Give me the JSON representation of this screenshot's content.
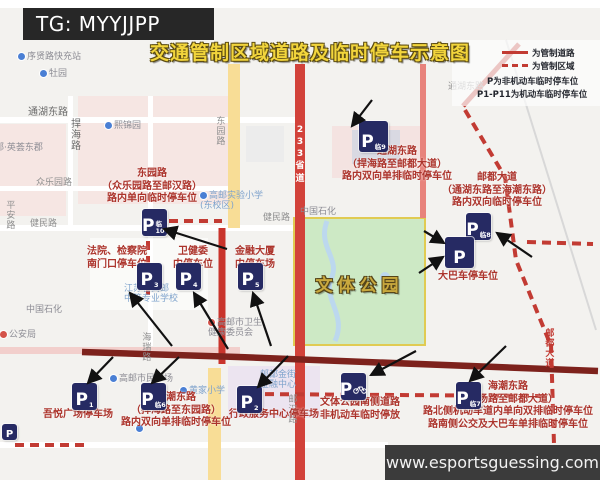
{
  "header": {
    "tg_label": "TG: MYYJJPP"
  },
  "title": "交通管制区域道路及临时停车示意图",
  "watermark": {
    "url_text": "www.esportsguessing.com"
  },
  "legend": {
    "rows": [
      {
        "swatch": "solid-red-line",
        "text": "为管制道路"
      },
      {
        "swatch": "dashed-red-line",
        "text": "为管制区域"
      },
      {
        "swatch": "none",
        "text": "P为非机动车临时停车位"
      },
      {
        "swatch": "none",
        "text": "P1-P11为机动车临时停车位"
      }
    ]
  },
  "park": {
    "name": "文体公园"
  },
  "colors": {
    "control_road_red": "#c23b33",
    "control_zone_dash_red": "#c23b33",
    "annotation_red": "#ac342c",
    "parking_icon_navy": "#262a63",
    "park_green": "#cde9c5",
    "park_border_yellow": "#e0cb52",
    "title_gold": "#f2d53c",
    "route_233_red": "#d2423a",
    "haichao_road_maroon": "#7d221c"
  },
  "map": {
    "labels": [
      {
        "name": "poi-xuxian-road-charging-station",
        "text": "序贤路快充站",
        "x": 18,
        "y": 52,
        "style": "poi",
        "pin": "blue"
      },
      {
        "name": "poi-muyuan",
        "text": "牡园",
        "x": 40,
        "y": 69,
        "style": "poi",
        "pin": "blue"
      },
      {
        "name": "road-label-tonghu-east-west",
        "text": "通湖东路",
        "x": 28,
        "y": 107,
        "style": "road-dark"
      },
      {
        "name": "road-label-tonghu-east-east",
        "text": "通湖东路",
        "x": 448,
        "y": 82,
        "style": "road"
      },
      {
        "name": "road-label-hanhai",
        "text": "捍海路",
        "x": 68,
        "y": 118,
        "style": "road-dark",
        "vertical": true
      },
      {
        "name": "road-label-dongyuan",
        "text": "东园路",
        "x": 214,
        "y": 116,
        "style": "road",
        "vertical": true
      },
      {
        "name": "poi-xijinyuan",
        "text": "熙锦园",
        "x": 105,
        "y": 121,
        "style": "poi",
        "pin": "blue"
      },
      {
        "name": "poi-yinghui-dongjun",
        "text": "南邮·英荟东郡",
        "x": -14,
        "y": 143,
        "style": "poi"
      },
      {
        "name": "road-label-zhongleyuan",
        "text": "众乐园路",
        "x": 36,
        "y": 178,
        "style": "road"
      },
      {
        "name": "road-label-pingan",
        "text": "平安路",
        "x": 4,
        "y": 200,
        "style": "road",
        "vertical": true
      },
      {
        "name": "road-label-jianmin-west",
        "text": "健民路",
        "x": 30,
        "y": 219,
        "style": "road"
      },
      {
        "name": "road-label-jianmin-east",
        "text": "健民路",
        "x": 263,
        "y": 213,
        "style": "road"
      },
      {
        "name": "poi-sinopec-east",
        "text": "中国石化",
        "x": 300,
        "y": 207,
        "style": "poi"
      },
      {
        "name": "poi-gaoyou-experimental-school",
        "lines": [
          "高邮实验小学",
          "(东校区)"
        ],
        "x": 200,
        "y": 191,
        "style": "poi-blue",
        "pin": "blue"
      },
      {
        "name": "poi-jiangsu-gaoyou-vocational-school",
        "lines": [
          "江苏省高邮",
          "中等专业学校"
        ],
        "x": 124,
        "y": 284,
        "style": "poi-blue"
      },
      {
        "name": "poi-sinopec-west",
        "text": "中国石化",
        "x": 26,
        "y": 305,
        "style": "poi"
      },
      {
        "name": "poi-health-commission",
        "lines": [
          "高邮市卫生",
          "健康委员会"
        ],
        "x": 208,
        "y": 318,
        "style": "poi",
        "pin": "red"
      },
      {
        "name": "poi-public-security-bureau",
        "text": "公安局",
        "x": 0,
        "y": 330,
        "style": "poi",
        "pin": "red"
      },
      {
        "name": "poi-gaoyou-civic-plaza",
        "text": "高邮市民广场",
        "x": 110,
        "y": 374,
        "style": "poi",
        "pin": "blue"
      },
      {
        "name": "poi-huangjia-school",
        "text": "黄家小学",
        "x": 180,
        "y": 386,
        "style": "poi-blue",
        "pin": "blue"
      },
      {
        "name": "poi-youdu-jinjie-finance-center",
        "lines": [
          "邮都金街",
          "金融中心"
        ],
        "x": 260,
        "y": 370,
        "style": "poi-blue"
      },
      {
        "name": "road-label-youhan",
        "text": "邮汉路",
        "x": 286,
        "y": 394,
        "style": "road",
        "vertical": true
      },
      {
        "name": "road-label-hairui",
        "text": "海瑞路",
        "x": 140,
        "y": 332,
        "style": "road",
        "vertical": true
      },
      {
        "name": "road-label-youdu-avenue",
        "text": "邮都大道",
        "x": 543,
        "y": 328,
        "style": "route-red",
        "vertical": true
      },
      {
        "name": "route-shield-233",
        "lines": [
          "2",
          "3",
          "3",
          "省",
          "道"
        ],
        "x": 294,
        "y": 124,
        "style": "route-white"
      },
      {
        "name": "poi-pin-bottom",
        "text": "",
        "x": 136,
        "y": 424,
        "style": "poi",
        "pin": "blue"
      }
    ],
    "p_icons": [
      {
        "id": "p-icon-lin9",
        "p": "P",
        "sub": "临9",
        "x": 359,
        "y": 121,
        "size": "lg"
      },
      {
        "id": "p-icon-lin8",
        "p": "P",
        "sub": "临8",
        "x": 466,
        "y": 213,
        "size": "md"
      },
      {
        "id": "p-icon-bus",
        "p": "P",
        "sub": "",
        "x": 445,
        "y": 237,
        "size": "lg"
      },
      {
        "id": "p-icon-lin10",
        "p": "P",
        "sub": "临10",
        "x": 142,
        "y": 209,
        "size": "md"
      },
      {
        "id": "p-icon-3",
        "p": "P",
        "sub": "3",
        "x": 137,
        "y": 263,
        "size": "md"
      },
      {
        "id": "p-icon-4",
        "p": "P",
        "sub": "4",
        "x": 176,
        "y": 263,
        "size": "md"
      },
      {
        "id": "p-icon-5",
        "p": "P",
        "sub": "5",
        "x": 238,
        "y": 263,
        "size": "md"
      },
      {
        "id": "p-icon-1",
        "p": "P",
        "sub": "1",
        "x": 72,
        "y": 383,
        "size": "md"
      },
      {
        "id": "p-icon-lin6",
        "p": "P",
        "sub": "临6",
        "x": 141,
        "y": 383,
        "size": "md"
      },
      {
        "id": "p-icon-2",
        "p": "P",
        "sub": "2",
        "x": 237,
        "y": 386,
        "size": "md"
      },
      {
        "id": "p-icon-bike",
        "p": "P",
        "sub": "bike",
        "x": 341,
        "y": 373,
        "size": "md"
      },
      {
        "id": "p-icon-lin7",
        "p": "P",
        "sub": "临7",
        "x": 456,
        "y": 382,
        "size": "md"
      },
      {
        "id": "p-icon-small-base",
        "p": "P",
        "sub": "",
        "x": 2,
        "y": 424,
        "size": "sm"
      }
    ],
    "annotations": [
      {
        "id": "annotation-dongyuan-road",
        "lines": [
          "东园路",
          "（众乐园路至邮汉路）",
          "路内单向临时停车位"
        ],
        "cx": 152,
        "y": 168
      },
      {
        "id": "annotation-tonghu-east-road",
        "lines": [
          "通湖东路",
          "（捍海路至邮都大道）",
          "路内双向单排临时停车位"
        ],
        "cx": 397,
        "y": 146
      },
      {
        "id": "annotation-youdu-avenue",
        "lines": [
          "邮都大道",
          "（通湖东路至海潮东路）",
          "路内双向临时停车位"
        ],
        "cx": 497,
        "y": 172
      },
      {
        "id": "annotation-bus-parking",
        "lines": [
          "大巴车停车位"
        ],
        "cx": 468,
        "y": 271
      },
      {
        "id": "annotation-court-procuratorate",
        "lines": [
          "法院、检察院",
          "南门口停车位"
        ],
        "cx": 117,
        "y": 246
      },
      {
        "id": "annotation-health-committee",
        "lines": [
          "卫健委",
          "内停车位"
        ],
        "cx": 193,
        "y": 246
      },
      {
        "id": "annotation-finance-tower",
        "lines": [
          "金融大厦",
          "内停车场"
        ],
        "cx": 255,
        "y": 246
      },
      {
        "id": "annotation-wuyue-plaza",
        "lines": [
          "吾悦广场停车场"
        ],
        "cx": 78,
        "y": 409
      },
      {
        "id": "annotation-haichao-east-west",
        "lines": [
          "海潮东路",
          "（捍海路至东园路）",
          "路内双向单排临时停车位"
        ],
        "cx": 176,
        "y": 392
      },
      {
        "id": "annotation-admin-service-center",
        "lines": [
          "行政服务中心停车场"
        ],
        "cx": 274,
        "y": 409
      },
      {
        "id": "annotation-park-south-road",
        "lines": [
          "文体公园南侧道路",
          "非机动车临时停放"
        ],
        "cx": 360,
        "y": 397
      },
      {
        "id": "annotation-haichao-east-east",
        "lines": [
          "海潮东路",
          "（绿杨路至邮都大道）",
          "路北侧机动车道内单向双排临时停车位",
          "路南侧公交及大巴车单排临时停车位"
        ],
        "cx": 508,
        "y": 381
      }
    ]
  }
}
